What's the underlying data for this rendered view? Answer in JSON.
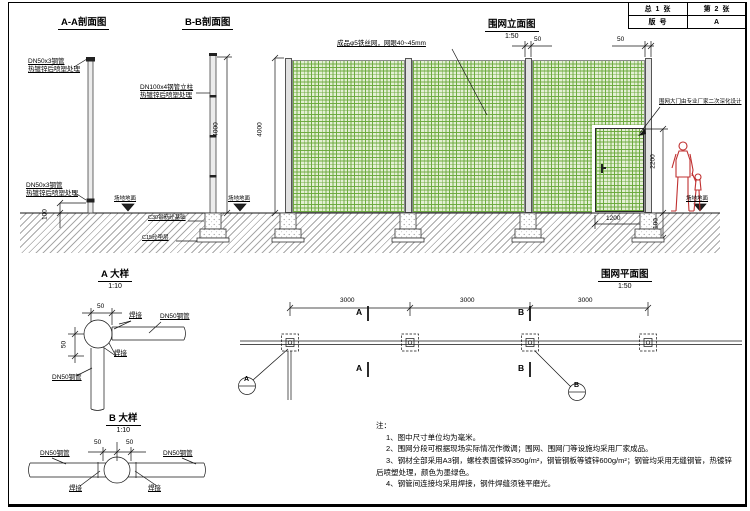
{
  "title_block": {
    "total": "总 1 张",
    "sheet": "第 2 张",
    "rev_label": "版 号",
    "rev": "A"
  },
  "aa": {
    "title": "A-A剖面图",
    "pipe": "DN50x3钢管",
    "treat": "热镀锌后喷塑处理",
    "dim_gap": "100"
  },
  "bb": {
    "title": "B-B剖面图",
    "post": "DN100x4钢管立柱",
    "treat": "热镀锌后喷塑处理",
    "dim_height": "4000",
    "ground": "场地地面",
    "foundation": "C30钢筋砼基础",
    "cushion": "C15砼垫层"
  },
  "elevation": {
    "title": "围网立面图",
    "scale": "1:50",
    "mesh": "成品φ5铁丝网，网眼40~45mm",
    "gate": "围网大门由专业厂家二次深化设计",
    "dim_post_gap": "50",
    "dim_height": "4000",
    "dim_door_h": "2200",
    "dim_door_w": "1200",
    "dim_found": "100",
    "ground": "场地地面"
  },
  "plan": {
    "title": "围网平面图",
    "scale": "1:50",
    "bay": "3000",
    "mark_a": "A",
    "mark_b": "B"
  },
  "detail_a": {
    "title": "A 大样",
    "scale": "1:10",
    "dim": "50",
    "weld": "焊接",
    "pipe": "DN50钢管"
  },
  "detail_b": {
    "title": "B 大样",
    "scale": "1:10",
    "dim": "50",
    "weld": "焊接",
    "pipe": "DN50钢管"
  },
  "notes": {
    "heading": "注：",
    "items": [
      "1、图中尺寸单位均为毫米。",
      "2、围网分段可根据现场实际情况作微调；围网、围网门等设施均采用厂家成品。",
      "3、钢材全部采用A3钢，螺栓表面镀锌350g/m²，钢管钢板等镀锌600g/m²；钢管均采用无缝钢管，热镀锌后喷塑处理，颜色为墨绿色。",
      "4、钢管间连接均采用焊接，钢件焊缝须锉平磨光。"
    ]
  },
  "colors": {
    "mesh_green": "#69a83a",
    "figure_red": "#c03030"
  }
}
